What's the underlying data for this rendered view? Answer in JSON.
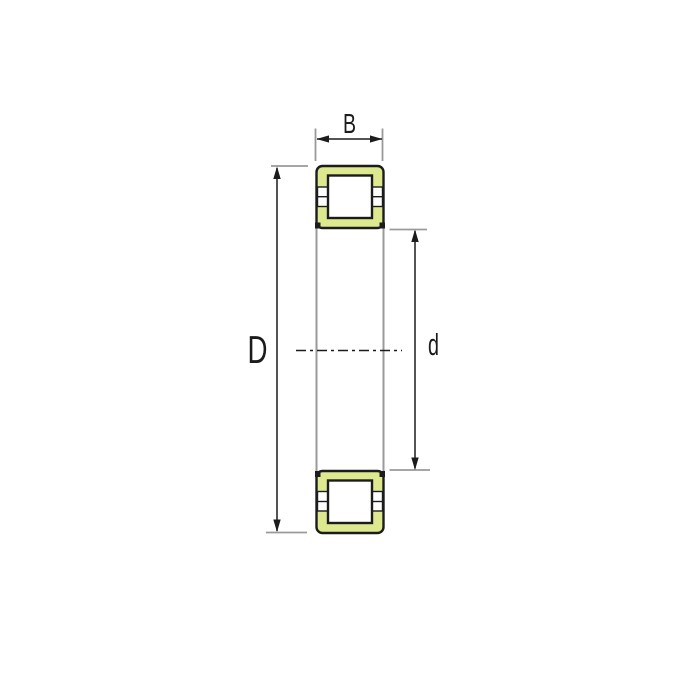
{
  "dimension_labels": {
    "width": "B",
    "outer_diameter": "D",
    "bore_diameter": "d"
  },
  "colors": {
    "ring_fill": "#dde88f",
    "roller_fill": "#ffffff",
    "line_black": "#1c1c1c",
    "construction_gray": "#9a9a9a",
    "background": "#ffffff"
  }
}
